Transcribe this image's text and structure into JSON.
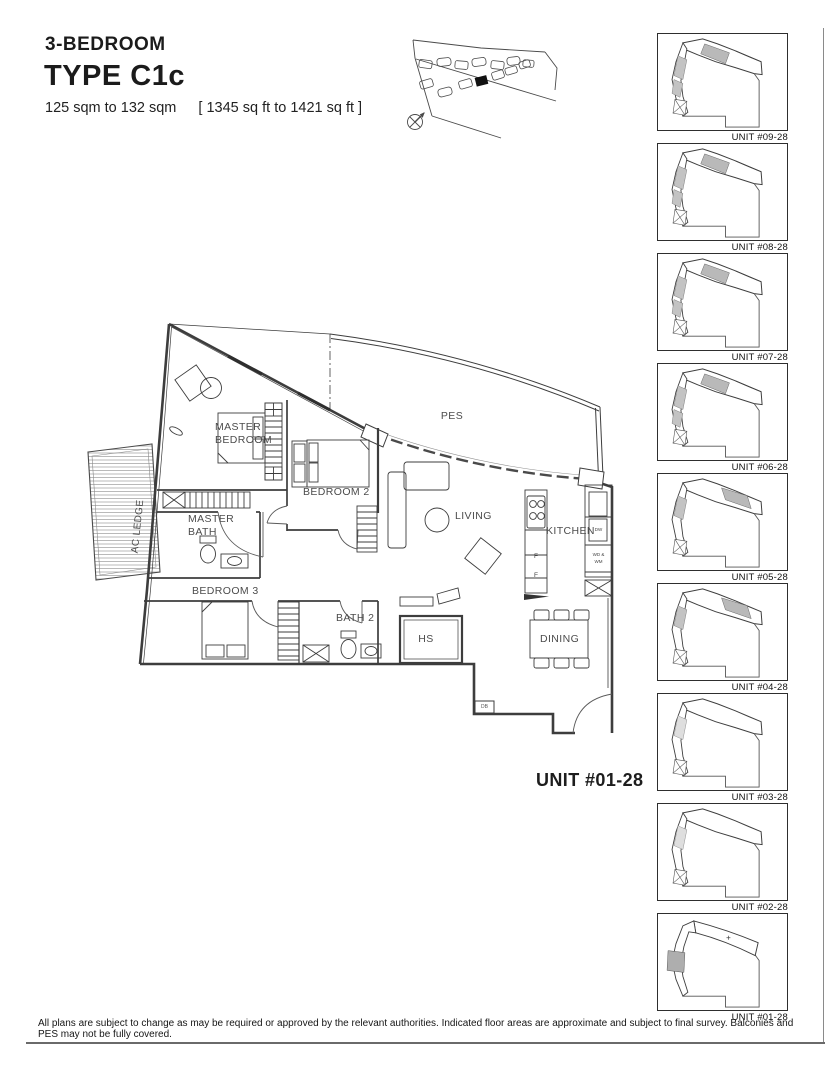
{
  "header": {
    "category": "3-BEDROOM",
    "type_code": "TYPE C1c",
    "area_metric": "125 sqm to 132 sqm",
    "area_imperial": "[ 1345 sq ft to 1421 sq ft ]"
  },
  "plan": {
    "rooms": {
      "master_bedroom": [
        "MASTER",
        "BEDROOM"
      ],
      "master_bath": [
        "MASTER",
        "BATH"
      ],
      "bedroom2": "BEDROOM 2",
      "bedroom3": "BEDROOM 3",
      "bath2": "BATH 2",
      "living": "LIVING",
      "dining": "DINING",
      "kitchen": "KITCHEN",
      "pes": "PES",
      "hs": "HS",
      "ac_ledge": "AC LEDGE",
      "db": "DB"
    },
    "appliances": {
      "fridge1": "F",
      "fridge2": "F",
      "dishwasher": "DW",
      "washer_line1": "WD &",
      "washer_line2": "WM"
    },
    "unit_label": "UNIT #01-28"
  },
  "key_plans": {
    "units": [
      {
        "label": "UNIT #09-28"
      },
      {
        "label": "UNIT #08-28"
      },
      {
        "label": "UNIT #07-28"
      },
      {
        "label": "UNIT #06-28"
      },
      {
        "label": "UNIT #05-28"
      },
      {
        "label": "UNIT #04-28"
      },
      {
        "label": "UNIT #03-28"
      },
      {
        "label": "UNIT #02-28"
      },
      {
        "label": "UNIT #01-28"
      }
    ]
  },
  "footer": {
    "disclaimer": "All plans are subject to change as may be required or approved by the relevant authorities. Indicated floor areas are approximate and subject to final survey. Balconies and PES may not be fully covered."
  },
  "colors": {
    "line": "#3d3d3d",
    "shade": "#b9b9b9",
    "background": "#ffffff"
  }
}
